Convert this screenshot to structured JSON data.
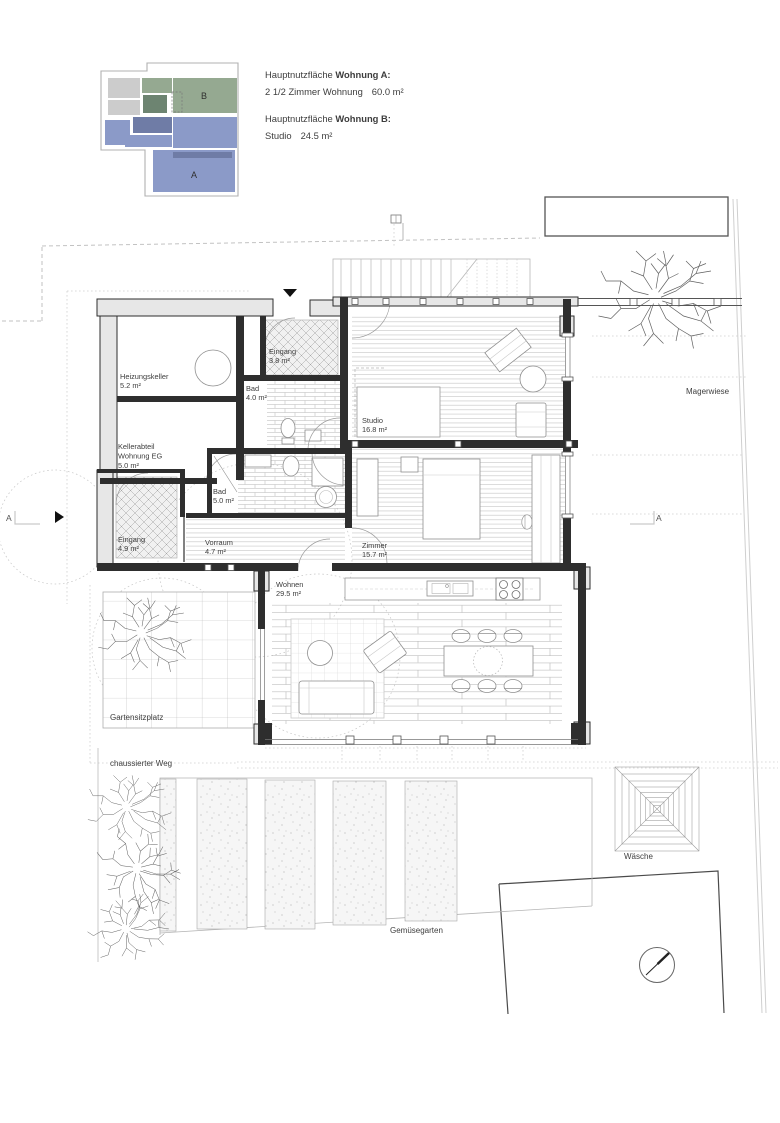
{
  "legend": {
    "keyplan": {
      "label_a": "A",
      "label_b": "B"
    },
    "a_title_prefix": "Hauptnutzfläche ",
    "a_title_bold": "Wohnung A:",
    "a_line_label": "2 1/2 Zimmer Wohnung",
    "a_line_value": "60.0 m²",
    "b_title_prefix": "Hauptnutzfläche ",
    "b_title_bold": "Wohnung B:",
    "b_line_label": "Studio",
    "b_line_value": "24.5 m²"
  },
  "rooms": {
    "heizungskeller": {
      "name": "Heizungskeller",
      "area": "5.2 m²"
    },
    "kellerabteil": {
      "name": "Kellerabteil",
      "name2": "Wohnung EG",
      "area": "5.0 m²"
    },
    "eingang_nord": {
      "name": "Eingang",
      "area": "3.8 m²"
    },
    "bad_og": {
      "name": "Bad",
      "area": "4.0 m²"
    },
    "studio": {
      "name": "Studio",
      "area": "16.8 m²"
    },
    "bad_eg": {
      "name": "Bad",
      "area": "5.0 m²"
    },
    "eingang_west": {
      "name": "Eingang",
      "area": "4.9 m²"
    },
    "vorraum": {
      "name": "Vorraum",
      "area": "4.7 m²"
    },
    "zimmer": {
      "name": "Zimmer",
      "area": "15.7 m²"
    },
    "wohnen": {
      "name": "Wohnen",
      "area": "29.5 m²"
    }
  },
  "site": {
    "magerwiese": "Magerwiese",
    "gartensitzplatz": "Gartensitzplatz",
    "weg": "chaussierter Weg",
    "gemuesegarten": "Gemüsegarten",
    "waesche": "Wäsche"
  },
  "section_markers": {
    "left": "A",
    "right": "A"
  },
  "colors": {
    "unit_a": "#8b9ac8",
    "unit_a_dark": "#6f7ca6",
    "unit_b": "#95a991",
    "unit_b_dark": "#6d8471",
    "keyplan_gray": "#cccccc",
    "wall_fill": "#e7e7e7"
  }
}
